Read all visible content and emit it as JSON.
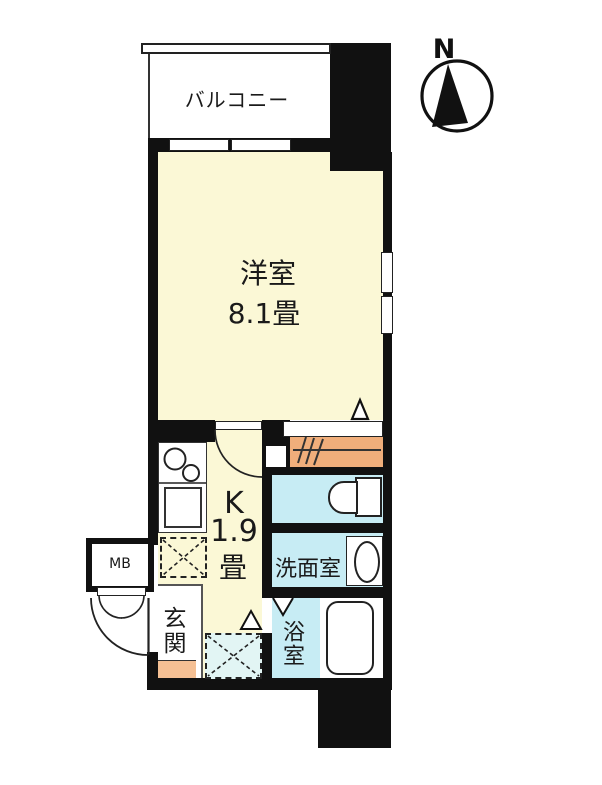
{
  "compass": {
    "label": "N"
  },
  "balcony": {
    "label": "バルコニー"
  },
  "living_room": {
    "label": "洋室",
    "area": "8.1畳"
  },
  "kitchen": {
    "label": "K",
    "area_value": "1.9",
    "area_unit": "畳"
  },
  "washroom": {
    "label": "洗面室"
  },
  "bathroom": {
    "label": "浴室"
  },
  "entrance": {
    "label": "玄関"
  },
  "meter_box": {
    "label": "MB"
  },
  "colors": {
    "wall": "#111111",
    "cream": "#FBF8D6",
    "closet": "#F0AE7B",
    "step": "#F5C094",
    "wet": "#C7ECF4",
    "washer": "#E2F5F4",
    "line": "#222222",
    "paper": "#FFFFFF"
  }
}
